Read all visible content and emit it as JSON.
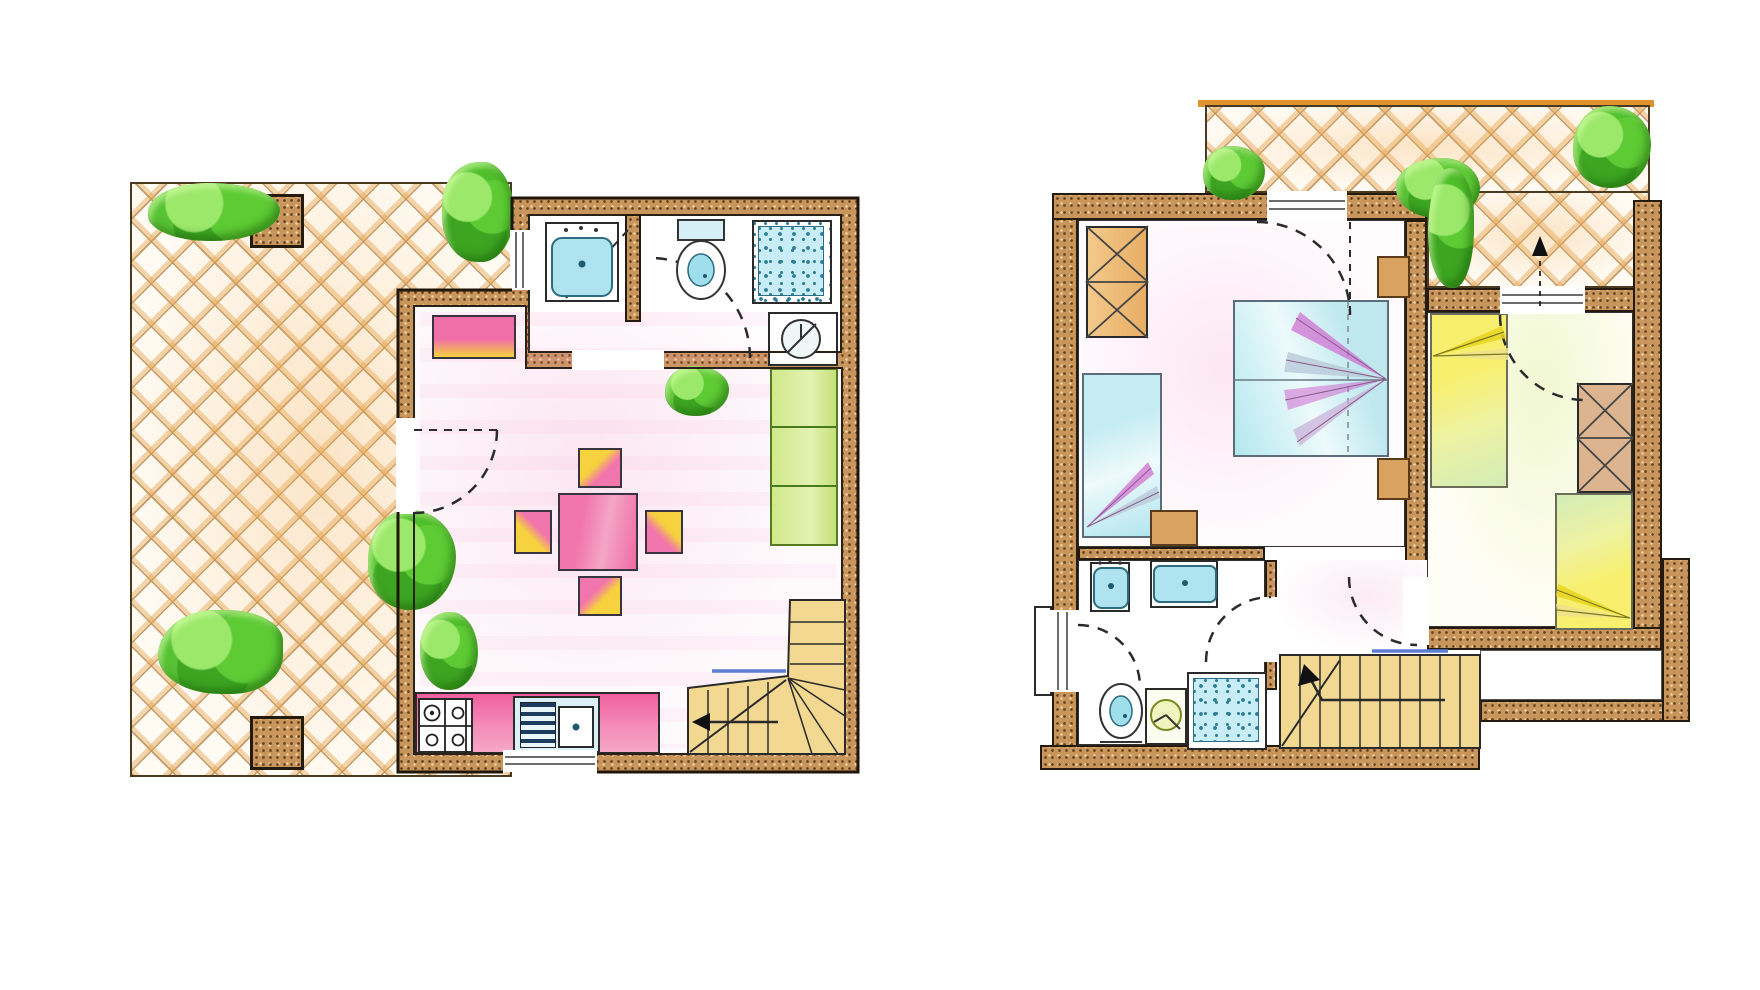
{
  "sheet": {
    "type": "hand-colored floor plan drawing",
    "background": "#ffffff",
    "floors": [
      {
        "id": "ground-floor",
        "position": "left",
        "outdoor": {
          "name": "terrace",
          "paving": "diagonal-lattice-tiles",
          "planter_boxes": 2,
          "bushes": 4
        },
        "rooms": [
          {
            "name": "bathroom",
            "fixtures": [
              "washbasin",
              "toilet",
              "shower-tray",
              "boiler"
            ]
          },
          {
            "name": "living-dining-room",
            "furniture": [
              "bench",
              "dining-table",
              "chair",
              "chair",
              "chair",
              "chair",
              "sofa",
              "potted-plant",
              "potted-plant"
            ]
          },
          {
            "name": "kitchenette",
            "fixtures": [
              "four-burner-stove",
              "sink-with-drainer",
              "counter"
            ]
          },
          {
            "name": "winder-staircase",
            "direction_arrow": "toward-left"
          }
        ]
      },
      {
        "id": "upper-floor",
        "position": "right",
        "outdoor": {
          "name": "balcony",
          "paving": "diagonal-lattice",
          "bushes": 4,
          "railing_accent": "orange"
        },
        "rooms": [
          {
            "name": "bedroom-1",
            "furniture": [
              "wardrobe",
              "single-bed",
              "double-bed",
              "nightstand",
              "nightstand",
              "nightstand"
            ]
          },
          {
            "name": "bathroom",
            "fixtures": [
              "washbasin",
              "washbasin",
              "toilet",
              "washing-machine",
              "shower-tray"
            ]
          },
          {
            "name": "bedroom-2",
            "furniture": [
              "single-bed",
              "single-bed",
              "wardrobe"
            ]
          },
          {
            "name": "staircase",
            "direction_arrow": "up"
          },
          {
            "name": "landing"
          }
        ]
      }
    ],
    "palette": {
      "wall": "#c8955c",
      "wall_speckle": "#7a5224",
      "outline": "#241a0e",
      "terrace_tile": "#e8b06a",
      "bush_green": "#49b32a",
      "furniture_pink": "#f176ad",
      "accent_yellow": "#f6d23e",
      "fixture_cyan": "#aee3ef",
      "bed_cyan": "#bfe9ef",
      "bed_yellow": "#f5e95f",
      "stair_tan": "#f3d891",
      "nosing_blue": "#5b7fd4",
      "pergola_orange": "#e0922e",
      "fan_magenta": "#d06ad0"
    }
  }
}
